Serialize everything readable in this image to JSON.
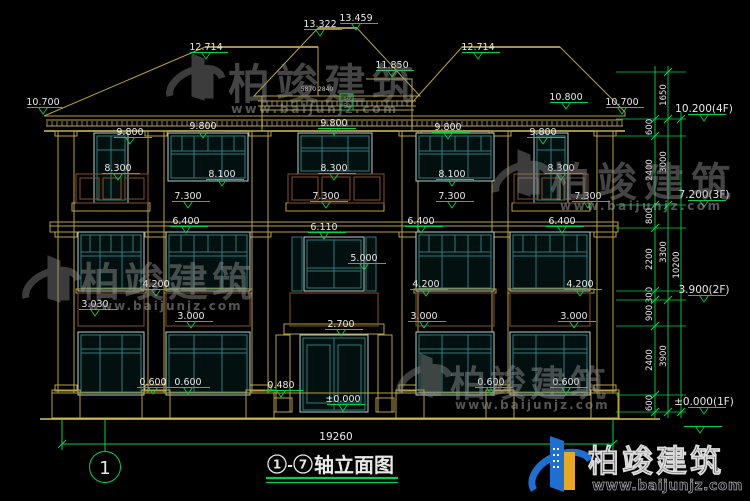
{
  "canvas": {
    "width": 750,
    "height": 501
  },
  "colors": {
    "background": "#000000",
    "cad_yellow": "#b9a23c",
    "dim_green": "#00d44a",
    "text_white": "#e8e8e8",
    "window_teal": "#2e7d7d",
    "railing_brown": "#7a4a26",
    "watermark_gray": "#979797",
    "logo_blue": "#1d6fd1",
    "logo_yellow": "#e8a821"
  },
  "watermark": {
    "brand": "柏竣建筑",
    "url": "www.baijunjz.com"
  },
  "title_block": {
    "full_title": "①-⑦轴立面图",
    "axis_left": "1",
    "dash": "-",
    "axis_right": "7",
    "suffix": "轴立面图",
    "overall_width": "19260",
    "axis_bubble": "1"
  },
  "floor_markers": [
    {
      "t": "10.200(4F)",
      "x": 704,
      "y": 112
    },
    {
      "t": "7.200(3F)",
      "x": 704,
      "y": 198
    },
    {
      "t": "3.900(2F)",
      "x": 704,
      "y": 293
    },
    {
      "t": "±0.000(1F)",
      "x": 704,
      "y": 405
    },
    {
      "t": "",
      "x": 700,
      "y": 424
    }
  ],
  "level_markers": [
    {
      "t": "13.322",
      "x": 320,
      "y": 27
    },
    {
      "t": "13.459",
      "x": 356,
      "y": 21
    },
    {
      "t": "12.714",
      "x": 206,
      "y": 50
    },
    {
      "t": "12.714",
      "x": 478,
      "y": 50
    },
    {
      "t": "11.850",
      "x": 392,
      "y": 68
    },
    {
      "t": "10.700",
      "x": 43,
      "y": 105
    },
    {
      "t": "10.800",
      "x": 566,
      "y": 100
    },
    {
      "t": "10.700",
      "x": 622,
      "y": 105
    },
    {
      "t": "9.800",
      "x": 130,
      "y": 135
    },
    {
      "t": "9.800",
      "x": 203,
      "y": 129
    },
    {
      "t": "9.800",
      "x": 334,
      "y": 126
    },
    {
      "t": "9.800",
      "x": 448,
      "y": 130
    },
    {
      "t": "9.800",
      "x": 543,
      "y": 135
    },
    {
      "t": "8.300",
      "x": 118,
      "y": 171
    },
    {
      "t": "8.300",
      "x": 334,
      "y": 171
    },
    {
      "t": "8.300",
      "x": 561,
      "y": 171
    },
    {
      "t": "8.100",
      "x": 222,
      "y": 177
    },
    {
      "t": "8.100",
      "x": 452,
      "y": 177
    },
    {
      "t": "7.300",
      "x": 188,
      "y": 199
    },
    {
      "t": "7.300",
      "x": 326,
      "y": 199
    },
    {
      "t": "7.300",
      "x": 452,
      "y": 199
    },
    {
      "t": "7.300",
      "x": 588,
      "y": 199
    },
    {
      "t": "6.400",
      "x": 186,
      "y": 224
    },
    {
      "t": "6.400",
      "x": 421,
      "y": 224
    },
    {
      "t": "6.400",
      "x": 562,
      "y": 224
    },
    {
      "t": "6.110",
      "x": 324,
      "y": 230
    },
    {
      "t": "5.000",
      "x": 364,
      "y": 261
    },
    {
      "t": "4.200",
      "x": 156,
      "y": 287
    },
    {
      "t": "4.200",
      "x": 426,
      "y": 287
    },
    {
      "t": "4.200",
      "x": 580,
      "y": 287
    },
    {
      "t": "3.030",
      "x": 95,
      "y": 307
    },
    {
      "t": "3.000",
      "x": 191,
      "y": 319
    },
    {
      "t": "3.000",
      "x": 424,
      "y": 319
    },
    {
      "t": "3.000",
      "x": 574,
      "y": 319
    },
    {
      "t": "2.700",
      "x": 341,
      "y": 327
    },
    {
      "t": "0.600",
      "x": 153,
      "y": 385
    },
    {
      "t": "0.600",
      "x": 188,
      "y": 385
    },
    {
      "t": "0.600",
      "x": 491,
      "y": 385
    },
    {
      "t": "0.600",
      "x": 566,
      "y": 385
    },
    {
      "t": "0.480",
      "x": 281,
      "y": 388
    },
    {
      "t": "±0.000",
      "x": 343,
      "y": 402
    }
  ],
  "chain_dims": [
    {
      "t": "1650",
      "x": 666,
      "y": 95
    },
    {
      "t": "600",
      "x": 652,
      "y": 127
    },
    {
      "t": "2400",
      "x": 652,
      "y": 170
    },
    {
      "t": "800",
      "x": 652,
      "y": 216
    },
    {
      "t": "2200",
      "x": 652,
      "y": 259
    },
    {
      "t": "300",
      "x": 652,
      "y": 295
    },
    {
      "t": "900",
      "x": 652,
      "y": 313
    },
    {
      "t": "2400",
      "x": 652,
      "y": 360
    },
    {
      "t": "600",
      "x": 652,
      "y": 403
    },
    {
      "t": "3000",
      "x": 666,
      "y": 162
    },
    {
      "t": "3300",
      "x": 666,
      "y": 252
    },
    {
      "t": "3900",
      "x": 666,
      "y": 356
    },
    {
      "t": "10200",
      "x": 679,
      "y": 265
    }
  ],
  "detail_dims": [
    {
      "t": "5870 2840",
      "x": 317,
      "y": 91,
      "s": 6,
      "c": "#cfcfcf"
    },
    {
      "t": "50",
      "x": 347,
      "y": 100,
      "s": 6,
      "c": "#00d44a"
    },
    {
      "t": "50",
      "x": 347,
      "y": 108,
      "s": 6,
      "c": "#00d44a"
    }
  ]
}
